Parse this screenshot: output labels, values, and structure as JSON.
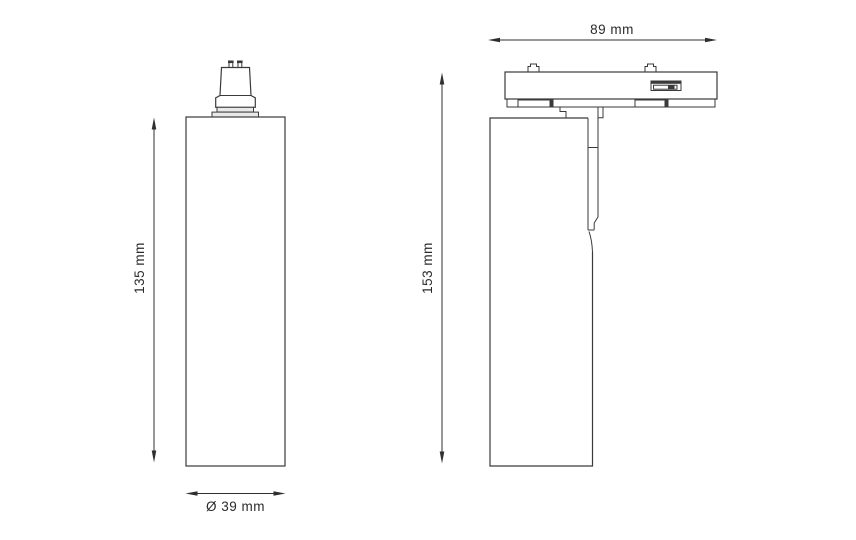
{
  "page": {
    "background": "#ffffff"
  },
  "drawing": {
    "line_color": "#3a3a3a",
    "dimension_color": "#2f2f2f",
    "text_color": "#2b2b2b",
    "front_view": {
      "height_label": "135 mm",
      "diameter_label": "Ø 39 mm"
    },
    "side_view": {
      "height_label": "153 mm",
      "width_label": "89 mm"
    }
  }
}
